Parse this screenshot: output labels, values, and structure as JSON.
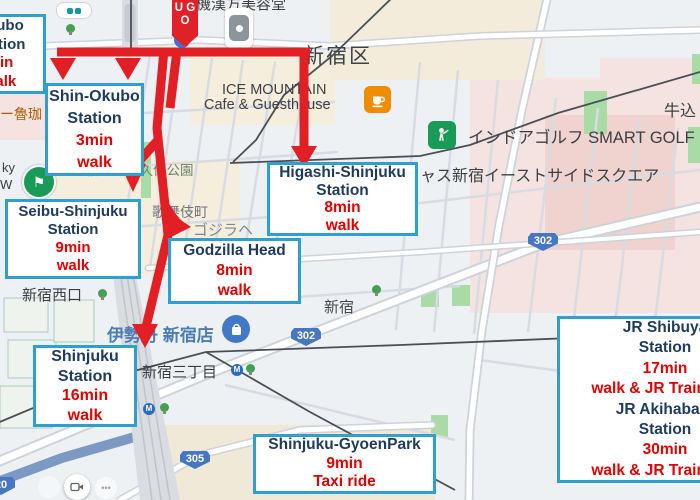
{
  "marker": {
    "letters": [
      "U",
      "G",
      "O"
    ]
  },
  "annotations": [
    {
      "id": "okubo-station",
      "lines": [
        {
          "text": "Okubo",
          "color": "navy"
        },
        {
          "text": "Station",
          "color": "navy"
        },
        {
          "text": "min",
          "color": "red"
        },
        {
          "text": "walk",
          "color": "red"
        }
      ]
    },
    {
      "id": "shin-okubo-station",
      "lines": [
        {
          "text": "Shin-Okubo",
          "color": "navy"
        },
        {
          "text": "Station",
          "color": "navy"
        },
        {
          "text": "3min",
          "color": "red"
        },
        {
          "text": "walk",
          "color": "red"
        }
      ]
    },
    {
      "id": "seibu-shinjuku-station",
      "lines": [
        {
          "text": "Seibu-Shinjuku",
          "color": "navy"
        },
        {
          "text": "Station",
          "color": "navy"
        },
        {
          "text": "9min",
          "color": "red"
        },
        {
          "text": "walk",
          "color": "red"
        }
      ]
    },
    {
      "id": "higashi-shinjuku-station",
      "lines": [
        {
          "text": "Higashi-Shinjuku",
          "color": "navy"
        },
        {
          "text": "Station",
          "color": "navy"
        },
        {
          "text": "8min",
          "color": "red"
        },
        {
          "text": "walk",
          "color": "red"
        }
      ]
    },
    {
      "id": "godzilla-head",
      "lines": [
        {
          "text": "Godzilla Head",
          "color": "navy"
        },
        {
          "text": "8min",
          "color": "red"
        },
        {
          "text": "walk",
          "color": "red"
        }
      ]
    },
    {
      "id": "shinjuku-station",
      "lines": [
        {
          "text": "Shinjuku",
          "color": "navy"
        },
        {
          "text": "Station",
          "color": "navy"
        },
        {
          "text": "16min",
          "color": "red"
        },
        {
          "text": "walk",
          "color": "red"
        }
      ]
    },
    {
      "id": "shinjuku-gyoen-park",
      "lines": [
        {
          "text": "Shinjuku-GyoenPark",
          "color": "navy"
        },
        {
          "text": "9min",
          "color": "red"
        },
        {
          "text": "Taxi ride",
          "color": "red"
        }
      ]
    },
    {
      "id": "jr-shibuya-akihabara",
      "lines": [
        {
          "text": "JR Shibuya",
          "color": "navy"
        },
        {
          "text": "Station",
          "color": "navy"
        },
        {
          "text": "17min",
          "color": "red"
        },
        {
          "text": "walk & JR Train ride",
          "color": "red"
        },
        {
          "text": "JR Akihabara",
          "color": "navy"
        },
        {
          "text": "Station",
          "color": "navy"
        },
        {
          "text": "30min",
          "color": "red"
        },
        {
          "text": "walk & JR Train ride",
          "color": "red"
        }
      ]
    }
  ],
  "map": {
    "labels": [
      {
        "id": "kanpo-beauty",
        "text": "機漢方美容堂"
      },
      {
        "id": "shinjuku-ku",
        "text": "新宿区"
      },
      {
        "id": "ice-mountain-1",
        "text": "ICE MOUNTAIN"
      },
      {
        "id": "ice-mountain-2",
        "text": "Cafe & Guesthouse"
      },
      {
        "id": "smart-golf",
        "text": "インドアゴルフ SMART GOLF"
      },
      {
        "id": "ushigome",
        "text": "牛込"
      },
      {
        "id": "eastside-square",
        "text": "ャス新宿イーストサイドスクエア"
      },
      {
        "id": "okubo-park",
        "text": "新宿区立大久保公園"
      },
      {
        "id": "kabukicho",
        "text": "歌舞伎町"
      },
      {
        "id": "godzilla-street",
        "text": "ゴジラヘ"
      },
      {
        "id": "shinjuku-west-exit",
        "text": "新宿西口"
      },
      {
        "id": "isetan",
        "text": "伊勢丹 新宿店"
      },
      {
        "id": "shinjuku-sanchome",
        "text": "新宿三丁目"
      },
      {
        "id": "shinjuku",
        "text": "新宿"
      },
      {
        "id": "roka",
        "text": "ー魯珈"
      },
      {
        "id": "edge-ky",
        "text": "ky"
      },
      {
        "id": "edge-w",
        "text": "W"
      },
      {
        "id": "metro-m-1",
        "text": "M"
      },
      {
        "id": "metro-m-2",
        "text": "M"
      }
    ],
    "road_badges": [
      {
        "id": "route-302-east",
        "text": "302"
      },
      {
        "id": "route-302-west",
        "text": "302"
      },
      {
        "id": "route-305",
        "text": "305"
      },
      {
        "id": "route-20",
        "text": "20"
      }
    ],
    "icons": [
      "coffee-cup-icon",
      "golf-icon",
      "flag-icon",
      "dice-tile-icon",
      "shopping-bag-icon",
      "metro-icon",
      "tree-icon",
      "camera-icon",
      "transit-pill-icon",
      "godzilla-poi-icon"
    ]
  },
  "colors": {
    "annotation_border": "#2f9fd0",
    "annotation_name": "#1e3a5f",
    "annotation_time": "#e00000",
    "arrow_red": "#e31f26",
    "badge_blue": "#4577c2",
    "isetan_blue": "#4a7db5",
    "park_green": "#a9dba6"
  }
}
